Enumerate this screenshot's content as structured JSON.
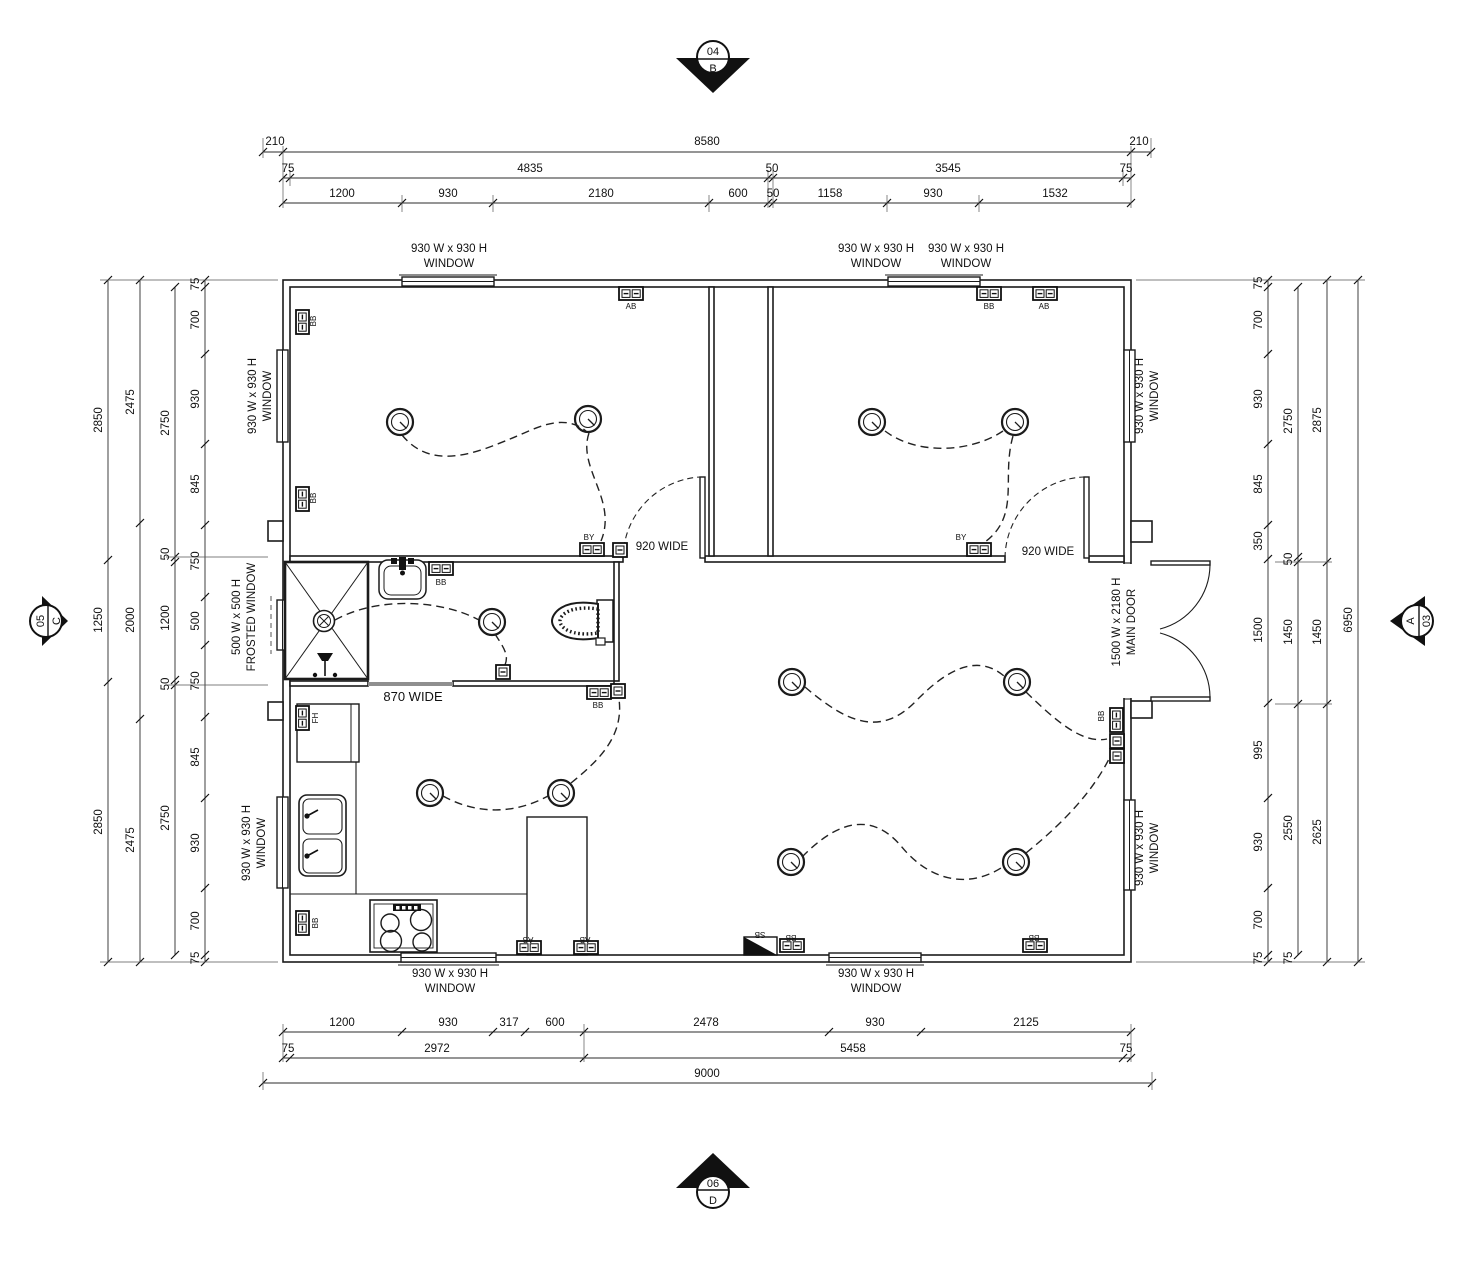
{
  "title": "Floor / Electrical Layout Plan",
  "markers": {
    "top": {
      "num": "04",
      "letter": "B"
    },
    "bottom": {
      "num": "06",
      "letter": "D"
    },
    "left": {
      "num": "05",
      "letter": "C"
    },
    "right": {
      "num": "A",
      "letter": "03"
    }
  },
  "legend": {
    "window_label": "930 W x 930 H WINDOW",
    "frosted_window_label": "500 W x 500 H FROSTED WINDOW",
    "main_door_label": "1500 W x 2180 H MAIN DOOR",
    "door_widths": [
      "920 WIDE",
      "870 WIDE"
    ],
    "switch_tags": [
      "AB",
      "BB",
      "BY",
      "FH",
      "SB"
    ]
  },
  "labels": [
    {
      "t": "210",
      "x": 275,
      "y": 145
    },
    {
      "t": "8580",
      "x": 707,
      "y": 145
    },
    {
      "t": "210",
      "x": 1139,
      "y": 145
    },
    {
      "t": "75",
      "x": 288,
      "y": 172
    },
    {
      "t": "4835",
      "x": 530,
      "y": 172
    },
    {
      "t": "50",
      "x": 772,
      "y": 172
    },
    {
      "t": "3545",
      "x": 948,
      "y": 172
    },
    {
      "t": "75",
      "x": 1126,
      "y": 172
    },
    {
      "t": "1200",
      "x": 342,
      "y": 197
    },
    {
      "t": "930",
      "x": 448,
      "y": 197
    },
    {
      "t": "2180",
      "x": 601,
      "y": 197
    },
    {
      "t": "600",
      "x": 738,
      "y": 197
    },
    {
      "t": "50",
      "x": 773,
      "y": 197
    },
    {
      "t": "1158",
      "x": 830,
      "y": 197
    },
    {
      "t": "930",
      "x": 933,
      "y": 197
    },
    {
      "t": "1532",
      "x": 1055,
      "y": 197
    },
    {
      "t": "1200",
      "x": 342,
      "y": 1026
    },
    {
      "t": "930",
      "x": 448,
      "y": 1026
    },
    {
      "t": "317",
      "x": 509,
      "y": 1026
    },
    {
      "t": "600",
      "x": 555,
      "y": 1026
    },
    {
      "t": "2478",
      "x": 706,
      "y": 1026
    },
    {
      "t": "930",
      "x": 875,
      "y": 1026
    },
    {
      "t": "2125",
      "x": 1026,
      "y": 1026
    },
    {
      "t": "75",
      "x": 288,
      "y": 1052
    },
    {
      "t": "2972",
      "x": 437,
      "y": 1052
    },
    {
      "t": "5458",
      "x": 853,
      "y": 1052
    },
    {
      "t": "75",
      "x": 1126,
      "y": 1052
    },
    {
      "t": "9000",
      "x": 707,
      "y": 1077
    },
    {
      "t": "2850",
      "x": 102,
      "y": 420,
      "r": -90
    },
    {
      "t": "1250",
      "x": 102,
      "y": 620,
      "r": -90
    },
    {
      "t": "2850",
      "x": 102,
      "y": 822,
      "r": -90
    },
    {
      "t": "2475",
      "x": 134,
      "y": 402,
      "r": -90
    },
    {
      "t": "2000",
      "x": 134,
      "y": 620,
      "r": -90
    },
    {
      "t": "2475",
      "x": 134,
      "y": 840,
      "r": -90
    },
    {
      "t": "2750",
      "x": 169,
      "y": 423,
      "r": -90
    },
    {
      "t": "50",
      "x": 169,
      "y": 554,
      "r": -90
    },
    {
      "t": "1200",
      "x": 169,
      "y": 618,
      "r": -90
    },
    {
      "t": "50",
      "x": 169,
      "y": 684,
      "r": -90
    },
    {
      "t": "2750",
      "x": 169,
      "y": 818,
      "r": -90
    },
    {
      "t": "75",
      "x": 199,
      "y": 284,
      "r": -90
    },
    {
      "t": "700",
      "x": 199,
      "y": 320,
      "r": -90
    },
    {
      "t": "930",
      "x": 199,
      "y": 399,
      "r": -90
    },
    {
      "t": "845",
      "x": 199,
      "y": 484,
      "r": -90
    },
    {
      "t": "750",
      "x": 199,
      "y": 561,
      "r": -90
    },
    {
      "t": "500",
      "x": 199,
      "y": 621,
      "r": -90
    },
    {
      "t": "750",
      "x": 199,
      "y": 681,
      "r": -90
    },
    {
      "t": "845",
      "x": 199,
      "y": 757,
      "r": -90
    },
    {
      "t": "930",
      "x": 199,
      "y": 843,
      "r": -90
    },
    {
      "t": "700",
      "x": 199,
      "y": 921,
      "r": -90
    },
    {
      "t": "75",
      "x": 199,
      "y": 958,
      "r": -90
    },
    {
      "t": "75",
      "x": 1262,
      "y": 283,
      "r": -90
    },
    {
      "t": "700",
      "x": 1262,
      "y": 320,
      "r": -90
    },
    {
      "t": "930",
      "x": 1262,
      "y": 399,
      "r": -90
    },
    {
      "t": "845",
      "x": 1262,
      "y": 484,
      "r": -90
    },
    {
      "t": "350",
      "x": 1262,
      "y": 541,
      "r": -90
    },
    {
      "t": "1500",
      "x": 1262,
      "y": 630,
      "r": -90
    },
    {
      "t": "995",
      "x": 1262,
      "y": 750,
      "r": -90
    },
    {
      "t": "930",
      "x": 1262,
      "y": 842,
      "r": -90
    },
    {
      "t": "700",
      "x": 1262,
      "y": 920,
      "r": -90
    },
    {
      "t": "75",
      "x": 1262,
      "y": 958,
      "r": -90
    },
    {
      "t": "2750",
      "x": 1292,
      "y": 421,
      "r": -90
    },
    {
      "t": "50",
      "x": 1292,
      "y": 559,
      "r": -90
    },
    {
      "t": "1450",
      "x": 1292,
      "y": 632,
      "r": -90
    },
    {
      "t": "2550",
      "x": 1292,
      "y": 828,
      "r": -90
    },
    {
      "t": "75",
      "x": 1292,
      "y": 958,
      "r": -90
    },
    {
      "t": "2875",
      "x": 1321,
      "y": 420,
      "r": -90
    },
    {
      "t": "1450",
      "x": 1321,
      "y": 632,
      "r": -90
    },
    {
      "t": "2625",
      "x": 1321,
      "y": 832,
      "r": -90
    },
    {
      "t": "6950",
      "x": 1352,
      "y": 620,
      "r": -90
    },
    {
      "t": "930 W x 930 H",
      "x": 449,
      "y": 252,
      "n": "annotation"
    },
    {
      "t": "WINDOW",
      "x": 449,
      "y": 267,
      "n": "annotation"
    },
    {
      "t": "930 W x 930 H",
      "x": 876,
      "y": 252,
      "n": "annotation"
    },
    {
      "t": "WINDOW",
      "x": 876,
      "y": 267,
      "n": "annotation"
    },
    {
      "t": "930 W x 930 H",
      "x": 966,
      "y": 252,
      "n": "annotation"
    },
    {
      "t": "WINDOW",
      "x": 966,
      "y": 267,
      "n": "annotation"
    },
    {
      "t": "930 W x 930 H",
      "x": 450,
      "y": 977,
      "n": "annotation"
    },
    {
      "t": "WINDOW",
      "x": 450,
      "y": 992,
      "n": "annotation"
    },
    {
      "t": "930 W x 930 H",
      "x": 876,
      "y": 977,
      "n": "annotation"
    },
    {
      "t": "WINDOW",
      "x": 876,
      "y": 992,
      "n": "annotation"
    },
    {
      "t": "930 W x 930 H",
      "x": 256,
      "y": 396,
      "r": -90,
      "n": "annotation"
    },
    {
      "t": "WINDOW",
      "x": 271,
      "y": 396,
      "r": -90,
      "n": "annotation"
    },
    {
      "t": "500 W x 500 H",
      "x": 240,
      "y": 617,
      "r": -90,
      "n": "annotation"
    },
    {
      "t": "FROSTED WINDOW",
      "x": 255,
      "y": 617,
      "r": -90,
      "n": "annotation"
    },
    {
      "t": "930 W x 930 H",
      "x": 250,
      "y": 843,
      "r": -90,
      "n": "annotation"
    },
    {
      "t": "WINDOW",
      "x": 265,
      "y": 843,
      "r": -90,
      "n": "annotation"
    },
    {
      "t": "930 W x 930 H",
      "x": 1143,
      "y": 396,
      "r": -90,
      "n": "annotation"
    },
    {
      "t": "WINDOW",
      "x": 1158,
      "y": 396,
      "r": -90,
      "n": "annotation"
    },
    {
      "t": "1500 W x 2180 H",
      "x": 1120,
      "y": 622,
      "r": -90,
      "n": "annotation"
    },
    {
      "t": "MAIN DOOR",
      "x": 1135,
      "y": 622,
      "r": -90,
      "n": "annotation"
    },
    {
      "t": "930 W x 930 H",
      "x": 1143,
      "y": 848,
      "r": -90,
      "n": "annotation"
    },
    {
      "t": "WINDOW",
      "x": 1158,
      "y": 848,
      "r": -90,
      "n": "annotation"
    },
    {
      "t": "920 WIDE",
      "x": 662,
      "y": 550,
      "n": "annotation"
    },
    {
      "t": "920 WIDE",
      "x": 1048,
      "y": 555,
      "n": "annotation"
    },
    {
      "t": "870 WIDE",
      "x": 413,
      "y": 701,
      "s": 13,
      "n": "annotation"
    },
    {
      "t": "AB",
      "x": 631,
      "y": 309,
      "s": 8,
      "n": "switch-label"
    },
    {
      "t": "BB",
      "x": 989,
      "y": 309,
      "s": 8,
      "n": "switch-label"
    },
    {
      "t": "AB",
      "x": 1044,
      "y": 309,
      "s": 8,
      "n": "switch-label"
    },
    {
      "t": "BB",
      "x": 316,
      "y": 321,
      "r": -90,
      "s": 8,
      "n": "switch-label"
    },
    {
      "t": "BB",
      "x": 316,
      "y": 498,
      "r": -90,
      "s": 8,
      "n": "switch-label"
    },
    {
      "t": "BY",
      "x": 589,
      "y": 540,
      "s": 8,
      "n": "switch-label"
    },
    {
      "t": "BY",
      "x": 961,
      "y": 540,
      "s": 8,
      "n": "switch-label"
    },
    {
      "t": "BB",
      "x": 441,
      "y": 585,
      "s": 8,
      "n": "switch-label"
    },
    {
      "t": "BB",
      "x": 598,
      "y": 708,
      "s": 8,
      "n": "switch-label"
    },
    {
      "t": "FH",
      "x": 318,
      "y": 718,
      "r": -90,
      "s": 8,
      "n": "switch-label"
    },
    {
      "t": "BB",
      "x": 318,
      "y": 923,
      "r": -90,
      "s": 8,
      "n": "switch-label"
    },
    {
      "t": "AB",
      "x": 528,
      "y": 937,
      "r": 180,
      "s": 8,
      "n": "switch-label"
    },
    {
      "t": "AB",
      "x": 585,
      "y": 937,
      "r": 180,
      "s": 8,
      "n": "switch-label"
    },
    {
      "t": "SB",
      "x": 760,
      "y": 932,
      "r": 180,
      "s": 8,
      "n": "switch-label"
    },
    {
      "t": "BB",
      "x": 791,
      "y": 935,
      "r": 180,
      "s": 8,
      "n": "switch-label"
    },
    {
      "t": "BB",
      "x": 1034,
      "y": 935,
      "r": 180,
      "s": 8,
      "n": "switch-label"
    },
    {
      "t": "BB",
      "x": 1104,
      "y": 716,
      "r": -90,
      "s": 8,
      "n": "switch-label"
    }
  ]
}
